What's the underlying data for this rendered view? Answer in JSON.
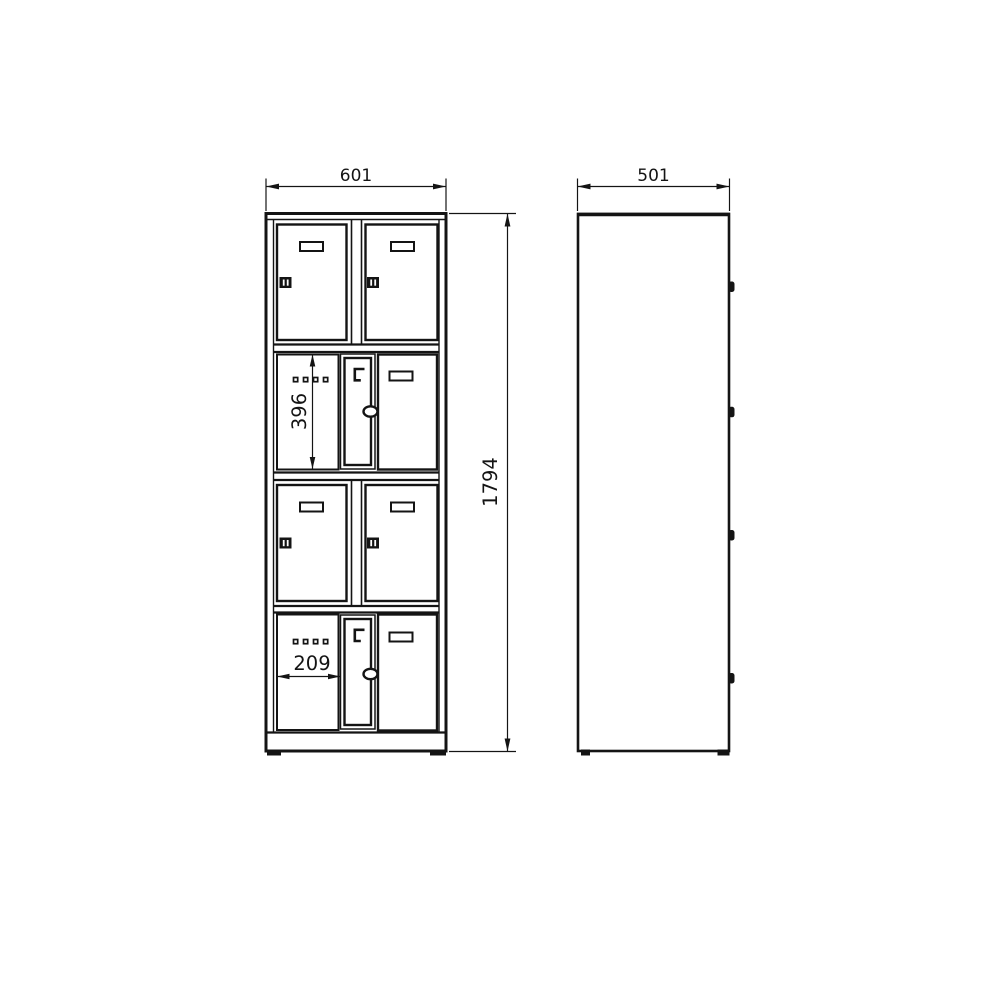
{
  "colors": {
    "background": "#ffffff",
    "line": "#141414"
  },
  "dimensions": {
    "front_width": "601",
    "side_depth": "501",
    "overall_height": "1794",
    "compartment_inner_height": "396",
    "compartment_inner_width": "209"
  }
}
